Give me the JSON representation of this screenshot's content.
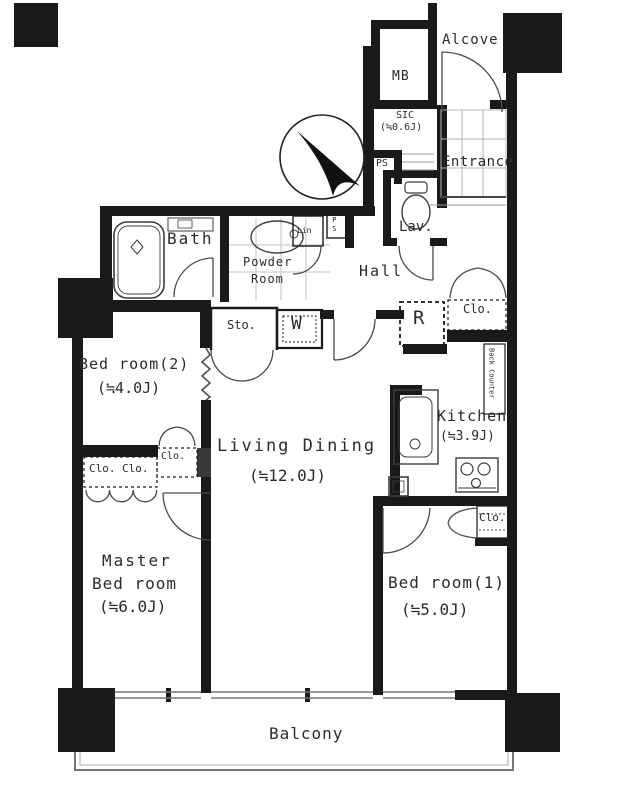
{
  "rooms": {
    "alcove": {
      "label": "Alcove"
    },
    "meter_box": {
      "label": "MB"
    },
    "shoe_closet": {
      "label": "SIC",
      "size": "(≒0.6J)"
    },
    "pipe_space_entrance": {
      "label": "PS"
    },
    "entrance": {
      "label": "Entrance"
    },
    "lavatory": {
      "label": "Lav."
    },
    "hall": {
      "label": "Hall"
    },
    "linen": {
      "label": "Lin"
    },
    "pipe_space_hall": {
      "label": "PS"
    },
    "bath": {
      "label": "Bath"
    },
    "powder_room": {
      "line1": "Powder",
      "line2": "Room"
    },
    "storage": {
      "label": "Sto."
    },
    "washer": {
      "label": "W"
    },
    "refrigerator": {
      "label": "R"
    },
    "closet_hall": {
      "label": "Clo."
    },
    "back_counter": {
      "label": "Back Counter"
    },
    "kitchen": {
      "label": "Kitchen",
      "size": "(≒3.9J)"
    },
    "closet_bedroom1": {
      "label": "Clo."
    },
    "bedroom1": {
      "label": "Bed room(1)",
      "size": "(≒5.0J)"
    },
    "living_dining": {
      "label": "Living Dining",
      "size": "(≒12.0J)"
    },
    "bedroom2": {
      "label": "Bed room(2)",
      "size": "(≒4.0J)"
    },
    "closet_bedroom2": {
      "label": "Clo."
    },
    "closet_master_left": {
      "label": "Clo."
    },
    "closet_master_right": {
      "label": "Clo."
    },
    "master_bedroom": {
      "line1": "Master",
      "line2": "Bed room",
      "size": "(≒6.0J)"
    },
    "balcony": {
      "label": "Balcony"
    }
  },
  "colors": {
    "wall": "#1a1a1a",
    "thin_line": "#666666",
    "text": "#2b2b2b",
    "background": "#ffffff"
  }
}
